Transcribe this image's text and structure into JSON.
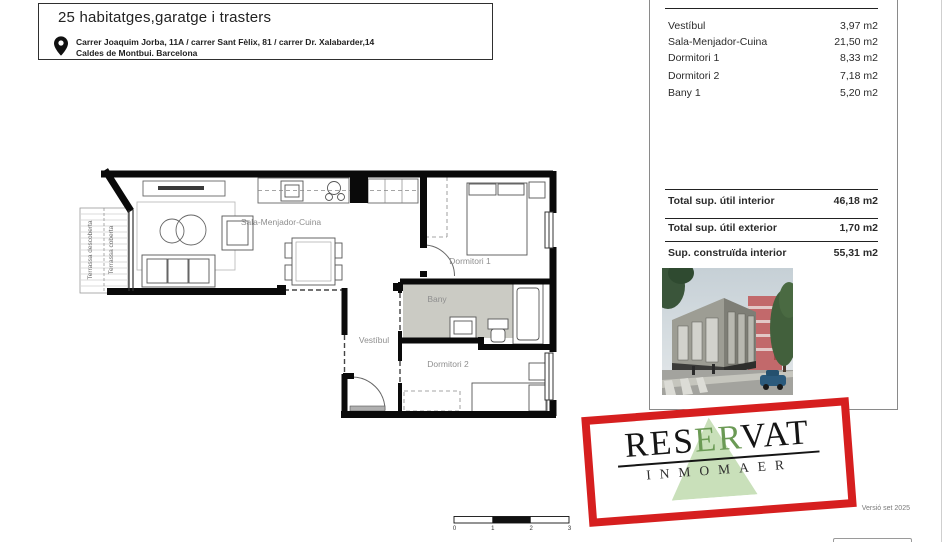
{
  "header": {
    "title": "25 habitatges,garatge i trasters",
    "address_line1": "Carrer Joaquim Jorba, 11A / carrer Sant Fèlix, 81 / carrer Dr. Xalabarder,14",
    "address_line2": "Caldes de Montbui. Barcelona"
  },
  "areas": {
    "rows": [
      {
        "label": "Vestíbul",
        "value": "3,97 m2"
      },
      {
        "label": "Sala-Menjador-Cuina",
        "value": "21,50 m2"
      },
      {
        "label": "Dormitori 1",
        "value": "8,33 m2"
      },
      {
        "label": "Dormitori 2",
        "value": "7,18 m2"
      },
      {
        "label": "Bany 1",
        "value": "5,20 m2"
      }
    ],
    "totals": [
      {
        "label": "Total sup. útil interior",
        "value": "46,18 m2"
      },
      {
        "label": "Total sup. útil exterior",
        "value": "1,70 m2"
      },
      {
        "label": "Sup. construïda interior",
        "value": "55,31 m2"
      }
    ]
  },
  "plan": {
    "rooms": {
      "sala": "Sala-Menjador-Cuina",
      "dormitori1": "Dormitori 1",
      "bany": "Bany",
      "vestibul": "Vestíbul",
      "dormitori2": "Dormitori 2",
      "terrassa_descoberta": "Terrassa descoberta",
      "terrassa_coberta": "Terrassa coberta"
    },
    "scale": {
      "t0": "0",
      "t1": "1",
      "t2": "2",
      "t3": "3"
    }
  },
  "stamp": {
    "res": "RES",
    "er": "ER",
    "vat": "VAT",
    "subtitle": "INMOMAER"
  },
  "footer": {
    "version": "Versió set 2025"
  },
  "colors": {
    "stamp_red": "#d61f1f",
    "stamp_green_triangle": "#c9e0ba",
    "stamp_green_letters": "#6b9a55",
    "bany_floor": "#cbcbc4"
  }
}
